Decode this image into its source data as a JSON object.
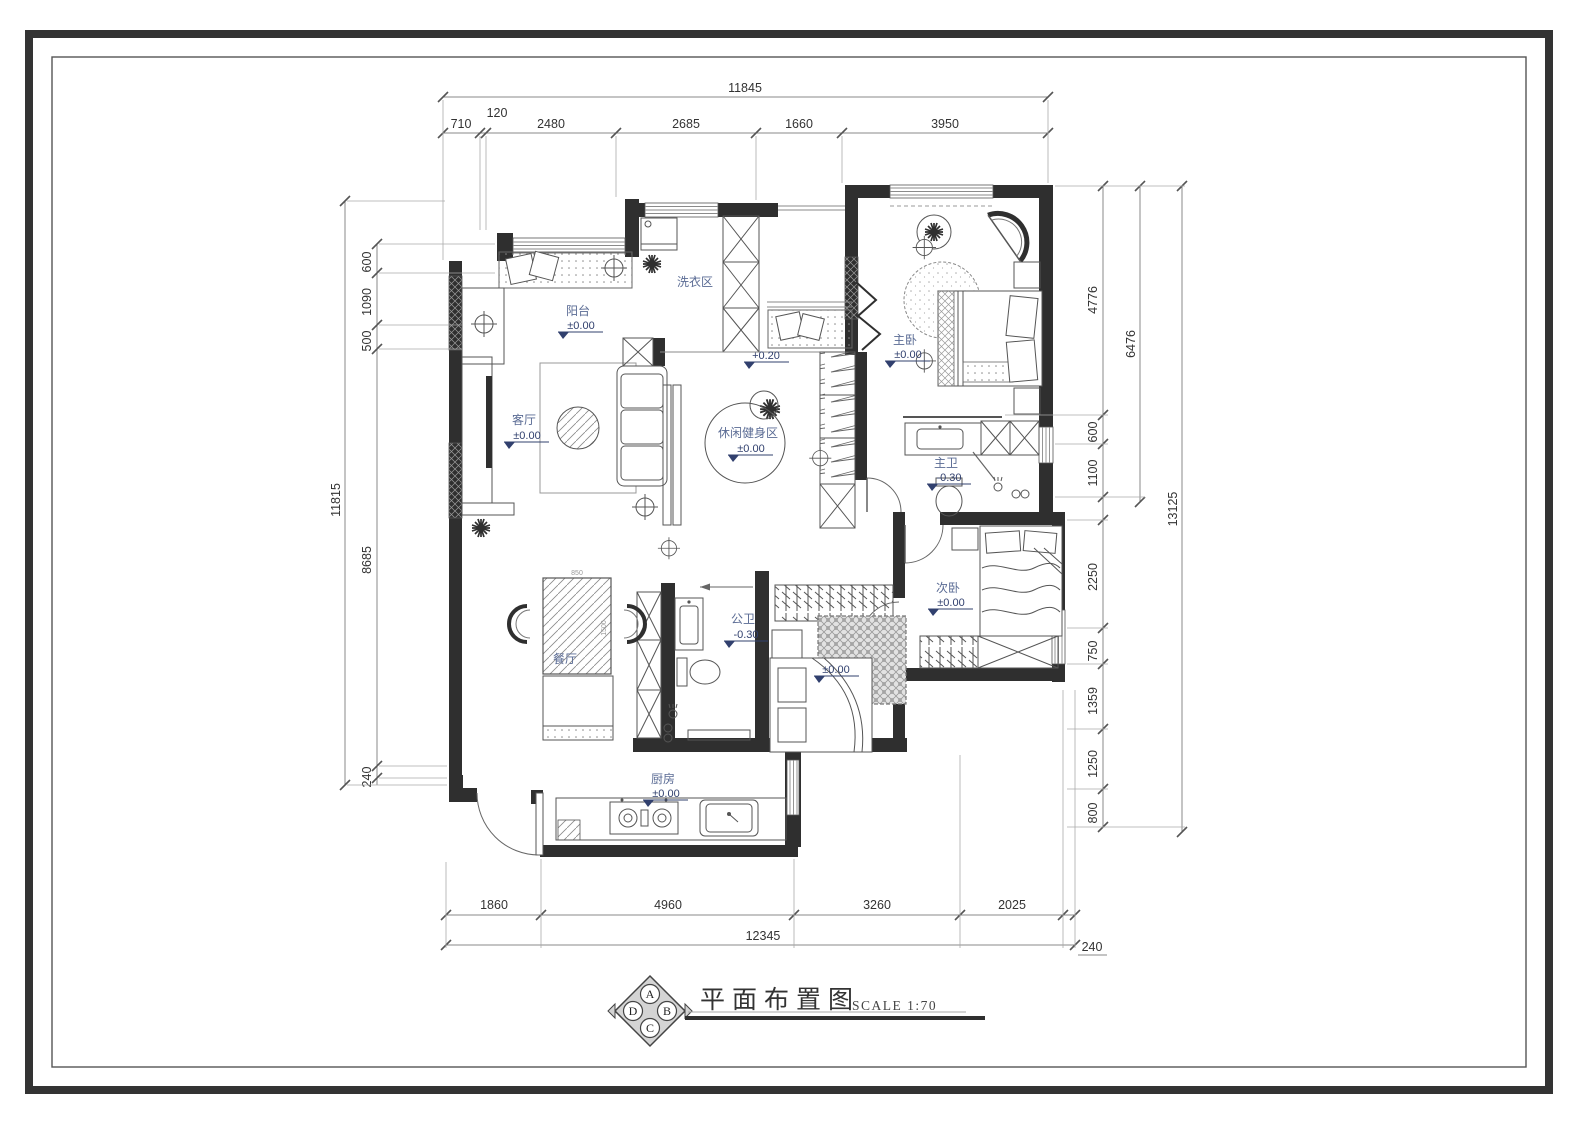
{
  "drawing": {
    "title": "平面布置图",
    "scale_label": "SCALE 1:70",
    "compass": {
      "top": "A",
      "right": "B",
      "bottom": "C",
      "left": "D"
    }
  },
  "dimensions": {
    "top": {
      "total": "11845",
      "segments": [
        "710",
        "120",
        "2480",
        "2685",
        "1660",
        "3950"
      ]
    },
    "left": {
      "total": "11815",
      "segments": [
        "600",
        "1090",
        "500",
        "8685",
        "240"
      ]
    },
    "right": {
      "total": "13125",
      "mid": "6476",
      "segments": [
        "4776",
        "600",
        "1100",
        "2250",
        "750",
        "1359",
        "1250",
        "800"
      ]
    },
    "bottom": {
      "total": "12345",
      "segments": [
        "1860",
        "4960",
        "3260",
        "2025",
        "240"
      ]
    }
  },
  "rooms": {
    "balcony": {
      "name": "阳台",
      "level": "±0.00"
    },
    "laundry": {
      "name": "洗衣区"
    },
    "master_bedroom": {
      "name": "主卧",
      "level": "±0.00"
    },
    "living_room": {
      "name": "客厅",
      "level": "±0.00"
    },
    "fitness": {
      "name": "休闲健身区",
      "level": "±0.00"
    },
    "hallway": {
      "level": "+0.20"
    },
    "master_bath": {
      "name": "主卫",
      "level": "-0.30"
    },
    "second_bedroom": {
      "name": "次卧",
      "level": "±0.00"
    },
    "public_bath": {
      "name": "公卫",
      "level": "-0.30"
    },
    "dining": {
      "name": "餐厅"
    },
    "bedroom3": {
      "level": "±0.00"
    },
    "kitchen": {
      "name": "厨房",
      "level": "±0.00"
    }
  },
  "furniture_dims": {
    "dining_table_w": "850",
    "dining_table_d": "1500"
  },
  "colors": {
    "wall": "#2f2f2f",
    "dimension": "#888888",
    "room_label": "#5a6b94",
    "level_label": "#31406e"
  }
}
